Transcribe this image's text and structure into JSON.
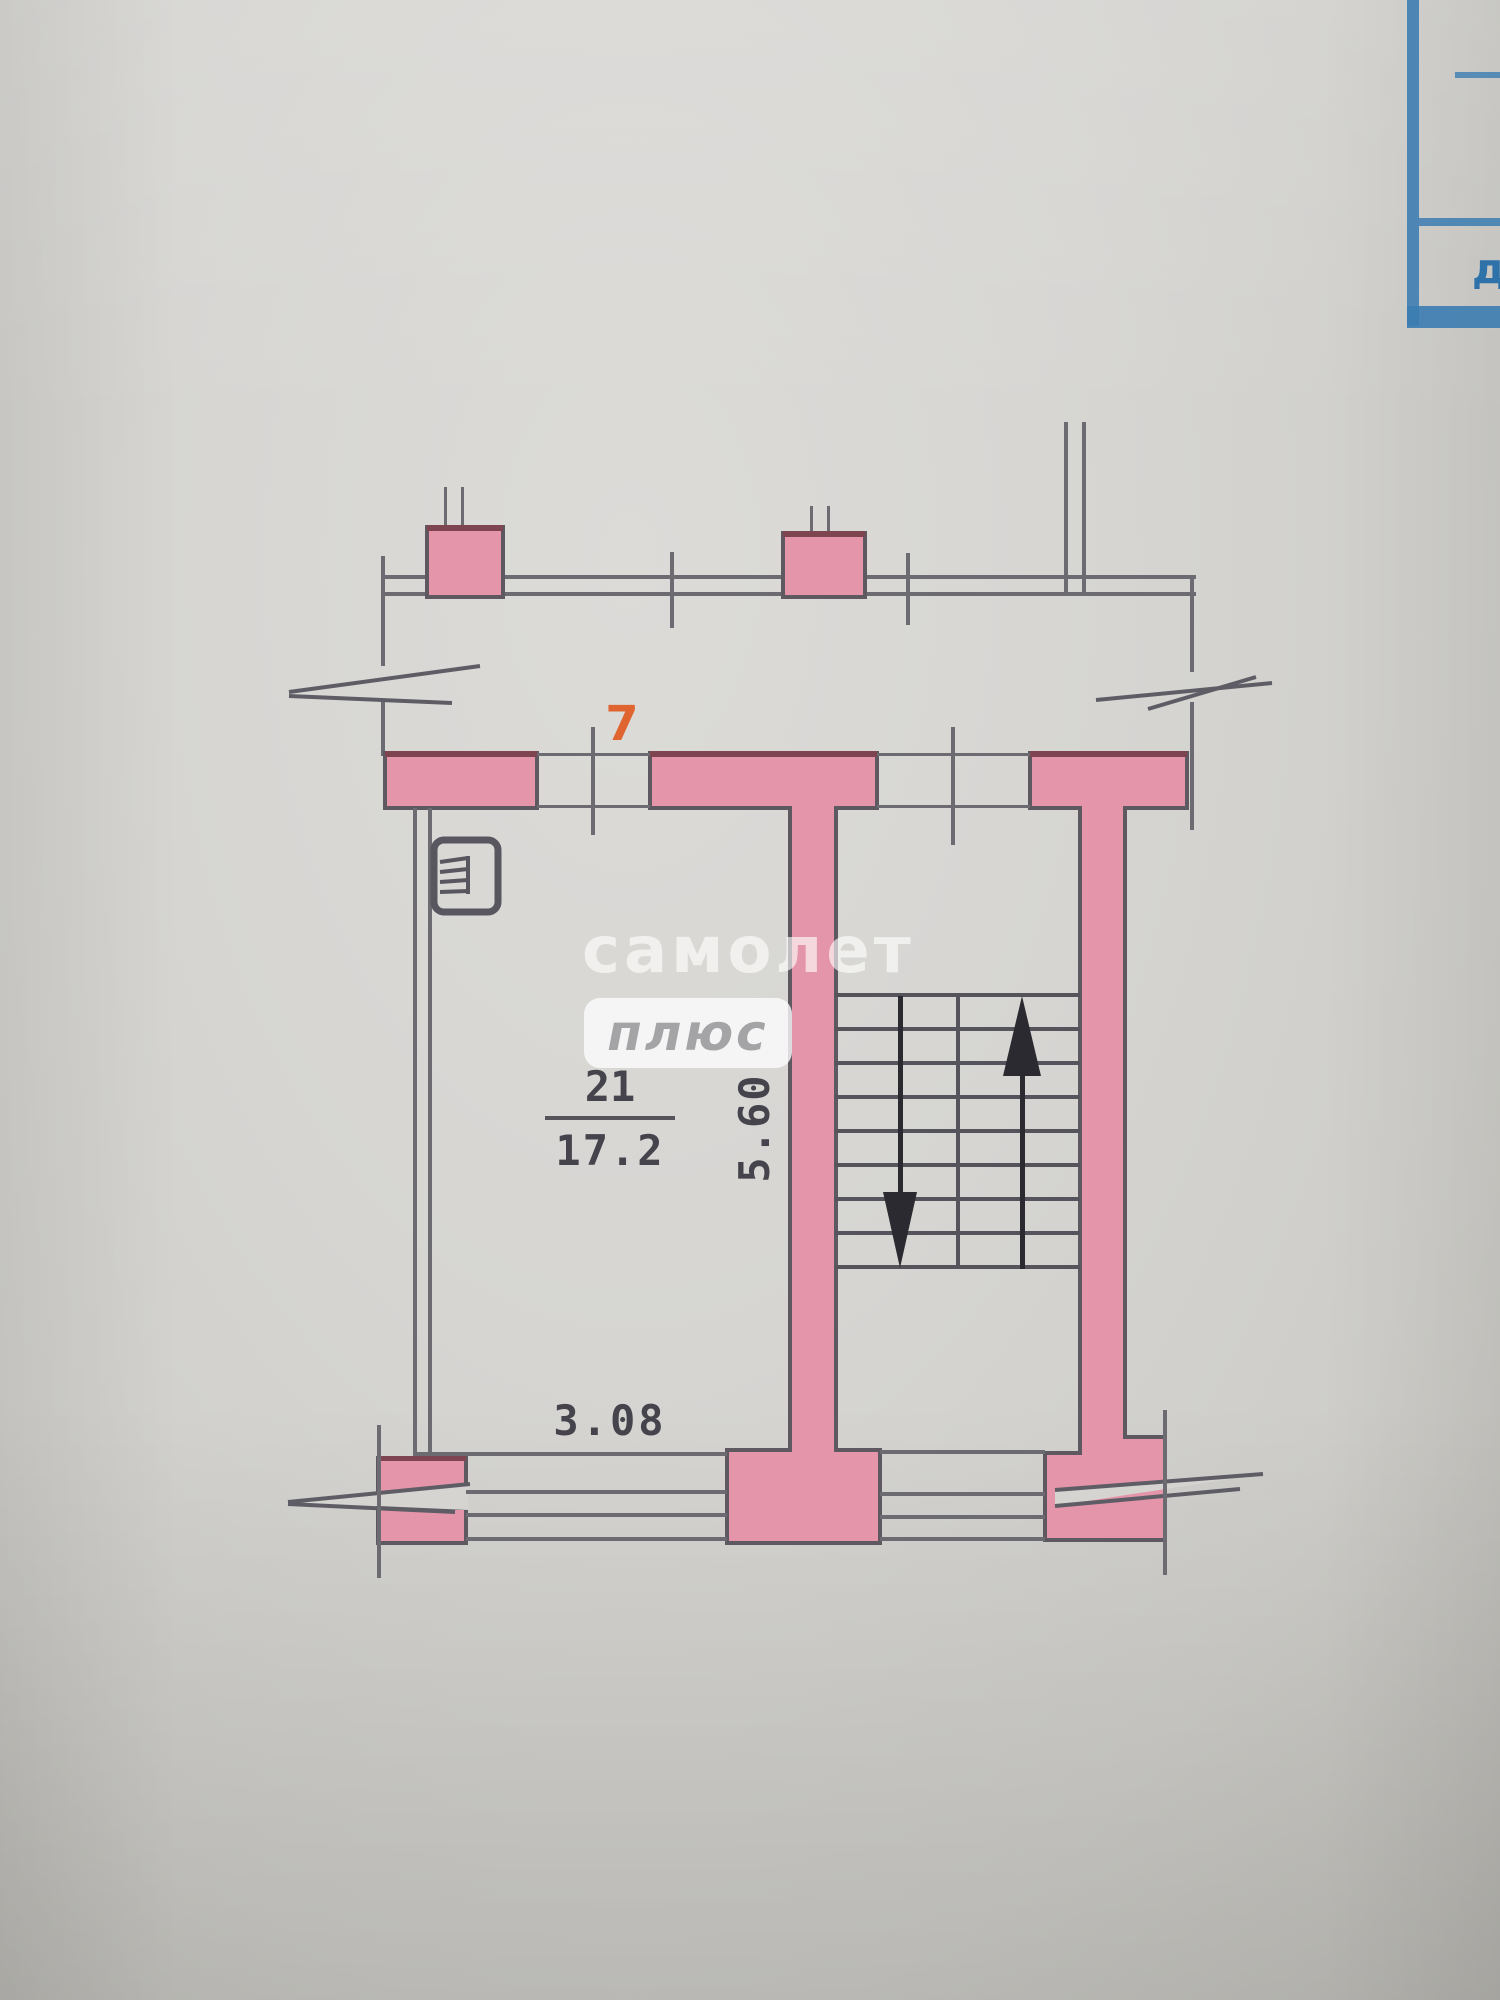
{
  "plan": {
    "flat_number": "7",
    "room_number": "21",
    "room_area": "17.2",
    "dim_vertical": "5.60",
    "dim_horizontal": "3.08"
  },
  "watermark": {
    "line1": "самолет",
    "line2": "плюс"
  },
  "corner_table": {
    "partial_letter": "д"
  },
  "colors": {
    "paper": "#d6d5d2",
    "wall_fill": "#e495a9",
    "wall_edge_dark": "#7e4450",
    "line_gray": "#5e5d65",
    "stair_line": "#55545c",
    "arrow_black": "#2b2a30",
    "accent_orange": "#df6430",
    "table_blue": "#3b7cb1",
    "dim_text": "#45444c",
    "watermark_plus_text": "#a4a4a6"
  }
}
